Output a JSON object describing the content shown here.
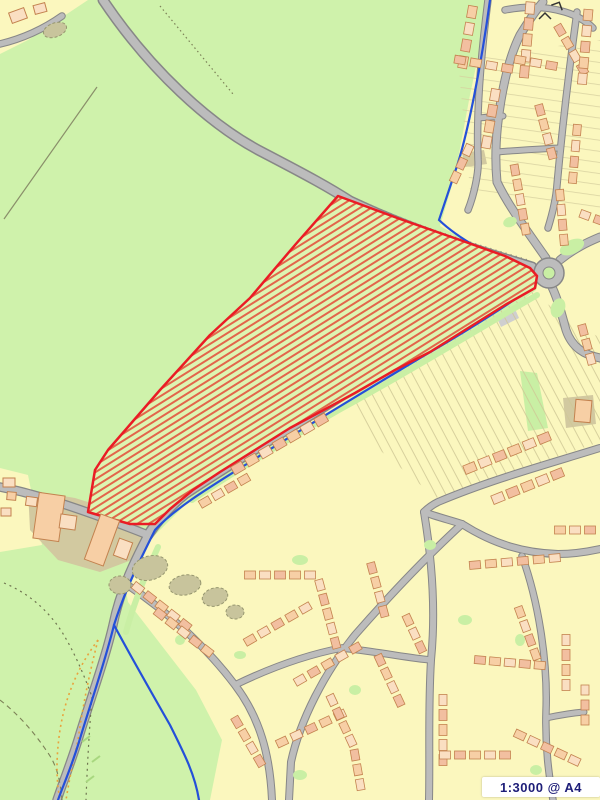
{
  "meta": {
    "scale_label": "1:3000 @ A4"
  },
  "colors": {
    "field_green": "#cff2ab",
    "site_green": "#ddf5b2",
    "residential_yellow": "#fbf7be",
    "building_fill": "#f7cfa5",
    "building_fill_2": "#fadfc2",
    "building_fill_3": "#f2bfa0",
    "building_outline": "#c3824f",
    "khaki": "#d2c9a0",
    "road_fill": "#bcbcbc",
    "road_casing": "#878787",
    "verge_green": "#c9efa4",
    "boundary_blue": "#2450d9",
    "site_red": "#ea1c25",
    "hatch_red": "#e2654a",
    "olive_line": "#7c8157",
    "orange_dots": "#e8a33d",
    "tree_fill": "#c8c49c",
    "tree_outline": "#96966f",
    "plot_line": "#cfc795",
    "scale_text": "#1e1e78"
  },
  "map": {
    "width": 600,
    "height": 800,
    "regions": [
      {
        "name": "residential-main",
        "fill": "#fbf7be",
        "points": "490,0 600,0 600,800 210,800 222,740 196,690 128,602 123,575 150,540 185,505 245,465 305,422 365,390 425,360 470,336 510,310 536,290 540,276 510,258 470,243 440,226 455,175 470,95"
      },
      {
        "name": "residential-topleft",
        "fill": "#fbf7be",
        "points": "0,0 88,0 58,20 28,40 0,54"
      },
      {
        "name": "residential-left-strip",
        "fill": "#fbf7be",
        "points": "0,468 28,475 42,545 0,552"
      },
      {
        "name": "farm-khaki",
        "fill": "#d2c9a0",
        "points": "28,490 75,498 120,512 148,532 142,556 100,572 58,560 30,530"
      },
      {
        "name": "green-wedge-plot",
        "fill": "#c9efa4",
        "points": "520,371 537,373 548,428 528,431"
      },
      {
        "name": "khaki-block-e",
        "fill": "#d2c9a0",
        "points": "563,398 593,395 596,424 566,428"
      },
      {
        "name": "khaki-block-ne",
        "fill": "#d2c9a0",
        "points": "462,153 484,150 487,164 465,167"
      },
      {
        "name": "gray-yard",
        "fill": "#c9c9c9",
        "points": "162,494 176,491 179,501 165,504"
      },
      {
        "name": "gray-strip",
        "fill": "#cfcfcf",
        "points": "497,318 515,309 519,318 501,327"
      }
    ],
    "plot_patterns": [
      {
        "name": "garden-plots-mid",
        "points": "352,398 532,292 558,312 600,338 600,442 436,498 368,440",
        "angle": 62,
        "spacing": 9,
        "color": "#cfc795",
        "width": 0.9
      },
      {
        "name": "garden-plots-ne",
        "points": "458,60 600,40 600,210 470,190",
        "angle": 8,
        "spacing": 11,
        "color": "#d6cf9e",
        "width": 0.8
      }
    ],
    "road_dot_lines": [
      {
        "d": "M99,-7 C146,63 206,118 258,145 C306,170 326,181 346,194 C416,227 476,244 528,260",
        "dash": "1.3 4"
      },
      {
        "d": "M107,7 C154,77 214,132 266,159 C314,184 334,195 354,208 C424,241 484,258 536,274",
        "dash": "1.3 4"
      },
      {
        "d": "M537,295 C475,331 405,374 335,412 C285,441 230,474 190,501",
        "dash": "1.3 4"
      },
      {
        "d": "M527,277 C465,313 395,356 325,394 C275,423 220,456 180,483",
        "dash": "1.3 4"
      }
    ],
    "green_strips": [
      {
        "d": "M537,295 C477,330 407,373 337,411 C287,440 232,473 192,500",
        "width": 6
      },
      {
        "d": "M158,547 C146,574 134,602 126,632",
        "width": 6
      }
    ],
    "roads": [
      {
        "name": "road-main-nw",
        "d": "M103,0 C150,70 210,125 262,152 C310,177 330,188 350,201 C420,234 480,251 532,267",
        "w": 8,
        "cw": 11
      },
      {
        "name": "road-sw",
        "d": "M532,278 C470,314 400,357 330,403 C280,434 225,467 185,494 C170,506 158,520 148,535",
        "w": 8,
        "cw": 11
      },
      {
        "name": "road-farm-w",
        "d": "M148,535 C110,520 70,505 30,494 C20,491 10,489 0,487",
        "w": 7,
        "cw": 9.5
      },
      {
        "name": "road-ssw",
        "d": "M148,535 C135,560 120,590 113,625 C105,660 90,700 78,740 C70,765 62,785 57,800",
        "w": 7,
        "cw": 9.5
      },
      {
        "name": "road-n-branch",
        "d": "M546,258 C525,228 508,205 497,182 C492,130 505,65 520,35 C528,22 536,10 543,2",
        "w": 7,
        "cw": 9
      },
      {
        "name": "road-arm-ne",
        "d": "M560,260 C575,248 588,242 600,237",
        "w": 7,
        "cw": 9
      },
      {
        "name": "road-arm-s",
        "d": "M552,287 C558,300 562,315 566,330 C572,348 585,355 600,358",
        "w": 7,
        "cw": 9
      },
      {
        "name": "road-topleft-spur",
        "d": "M0,44 C25,38 45,28 62,16",
        "w": 5.5,
        "cw": 7.5
      },
      {
        "name": "road-ne-a",
        "d": "M488,0 C481,55 476,110 478,160 C479,172 474,195 468,210",
        "w": 5.5,
        "cw": 7.5
      },
      {
        "name": "road-ne-b",
        "d": "M478,118 L503,116",
        "w": 5,
        "cw": 7
      },
      {
        "name": "road-ne-d",
        "d": "M577,12 C569,70 562,130 557,185 C556,200 552,215 548,228",
        "w": 5.5,
        "cw": 7.5
      },
      {
        "name": "road-ne-e",
        "d": "M497,152 C520,150 540,149 558,148",
        "w": 5,
        "cw": 7
      },
      {
        "name": "road-ne-f",
        "d": "M505,10 C525,6 545,6 565,12 C575,15 585,20 593,28",
        "w": 5.5,
        "cw": 7.5
      },
      {
        "name": "street-a",
        "d": "M462,524 C425,558 390,595 355,635 C325,672 300,720 291,762 L289,800",
        "w": 6,
        "cw": 8
      },
      {
        "name": "street-b",
        "d": "M126,584 C165,610 205,645 235,685 C260,718 270,755 272,800",
        "w": 6,
        "cw": 8
      },
      {
        "name": "street-c",
        "d": "M600,448 C545,465 490,480 438,502 C432,505 428,508 424,512",
        "w": 6,
        "cw": 8
      },
      {
        "name": "street-d",
        "d": "M424,512 C432,560 436,610 431,660 C428,710 430,755 429,800",
        "w": 6,
        "cw": 8
      },
      {
        "name": "street-e",
        "d": "M235,685 C270,668 305,655 342,648",
        "w": 5.5,
        "cw": 7.5
      },
      {
        "name": "street-g",
        "d": "M342,648 C380,652 408,658 431,660",
        "w": 5.5,
        "cw": 7.5
      },
      {
        "name": "street-h",
        "d": "M462,524 C495,545 525,553 558,554 C572,554 586,552 600,549",
        "w": 6,
        "cw": 8
      },
      {
        "name": "street-i",
        "d": "M522,556 C538,600 548,660 546,712 C545,748 549,775 553,800",
        "w": 5.5,
        "cw": 7.5
      },
      {
        "name": "street-k",
        "d": "M546,718 C560,715 572,713 584,712",
        "w": 5,
        "cw": 7
      },
      {
        "name": "street-n",
        "d": "M126,584 C120,600 116,612 113,625",
        "w": 5.5,
        "cw": 7.5
      },
      {
        "name": "street-ak",
        "d": "M424,512 C437,517 450,520 462,524",
        "w": 6,
        "cw": 8
      }
    ],
    "roundabout": {
      "cx": 549,
      "cy": 273,
      "r_outer": 15,
      "r_island": 6
    },
    "lines": [
      {
        "name": "field-boundary-nw",
        "d": "M97,87 L4,219",
        "color": "#8a8f6a",
        "width": 1.2,
        "dash": ""
      },
      {
        "name": "track-top",
        "d": "M160,6 L233,94",
        "color": "#7c8157",
        "width": 1.2,
        "dash": "1.5 3"
      },
      {
        "name": "path-sw-1",
        "d": "M4,583 Q40,598 62,632 Q78,658 92,697",
        "color": "#6f7550",
        "width": 1.2,
        "dash": "2 4"
      },
      {
        "name": "path-sw-2",
        "d": "M92,697 Q88,745 86,800",
        "color": "#6f7550",
        "width": 1.2,
        "dash": "2 4"
      },
      {
        "name": "path-sw-3",
        "d": "M0,700 Q28,722 50,756 Q60,772 62,800",
        "color": "#7c8157",
        "width": 1.1,
        "dash": "5 4"
      },
      {
        "name": "orange-loop-left",
        "d": "M98,640 Q68,680 60,730 Q54,770 60,800",
        "color": "#e8a33d",
        "width": 1.6,
        "dash": "2 3.5"
      },
      {
        "name": "orange-loop-right",
        "d": "M98,640 Q85,690 78,740 Q70,775 66,800",
        "color": "#e8a33d",
        "width": 1.6,
        "dash": "2 3.5"
      },
      {
        "name": "grass-dash-1",
        "d": "M82,742 L90,736",
        "color": "#a8d77f",
        "width": 2,
        "dash": ""
      },
      {
        "name": "grass-dash-2",
        "d": "M92,762 L100,756",
        "color": "#a8d77f",
        "width": 2,
        "dash": ""
      },
      {
        "name": "grass-dash-3",
        "d": "M86,782 L94,776",
        "color": "#a8d77f",
        "width": 2,
        "dash": ""
      }
    ],
    "blue_boundary": [
      {
        "name": "blue-main",
        "d": "M490,0 C482,60 468,135 455,172 L439,220 C460,240 490,255 520,268 C530,272 536,276 533,287 C500,310 460,335 420,358 C370,388 300,430 250,462 C210,487 175,508 155,530 C140,560 125,590 114,625 C105,662 90,705 79,742 C71,768 63,786 58,800"
      },
      {
        "name": "blue-branch",
        "d": "M114,625 C130,655 150,690 170,725 C185,755 195,775 199,800"
      }
    ],
    "site_polygon": {
      "points": "338,196 400,219 460,240 505,256 530,268 537,276 535,288 505,305 465,330 430,352 395,370 355,393 320,412 290,428 255,450 220,472 193,490 170,509 155,524 130,524 105,517 88,512 95,470 108,450 160,390 210,335 250,298 295,245",
      "hatch_angle": -32,
      "hatch_spacing": 6,
      "hatch_width": 2
    },
    "buildings": [
      {
        "x": 36,
        "y": 494,
        "w": 26,
        "h": 46,
        "rot": 8,
        "f": 0
      },
      {
        "x": 60,
        "y": 515,
        "w": 16,
        "h": 14,
        "rot": 8,
        "f": 1
      },
      {
        "x": 92,
        "y": 516,
        "w": 20,
        "h": 48,
        "rot": 20,
        "f": 0
      },
      {
        "x": 116,
        "y": 540,
        "w": 14,
        "h": 18,
        "rot": 20,
        "f": 1
      },
      {
        "x": 26,
        "y": 497,
        "w": 11,
        "h": 9,
        "rot": 8,
        "f": 1
      },
      {
        "x": 3,
        "y": 478,
        "w": 12,
        "h": 9,
        "rot": 0,
        "f": 1
      },
      {
        "x": 7,
        "y": 492,
        "w": 9,
        "h": 8,
        "rot": 5,
        "f": 0
      },
      {
        "x": 1,
        "y": 508,
        "w": 10,
        "h": 8,
        "rot": 0,
        "f": 1
      },
      {
        "x": 10,
        "y": 10,
        "w": 16,
        "h": 11,
        "rot": -20,
        "f": 1
      },
      {
        "x": 34,
        "y": 4,
        "w": 12,
        "h": 9,
        "rot": -15,
        "f": 1
      },
      {
        "x": 575,
        "y": 400,
        "w": 16,
        "h": 22,
        "rot": 5,
        "f": 0
      }
    ],
    "house_rows": [
      {
        "x": 472,
        "y": 12,
        "rot": 100,
        "n": 4,
        "sp": 17,
        "w": 12,
        "h": 9
      },
      {
        "x": 530,
        "y": 8,
        "rot": 95,
        "n": 5,
        "sp": 16,
        "w": 12,
        "h": 9
      },
      {
        "x": 560,
        "y": 30,
        "rot": 60,
        "n": 4,
        "sp": 15,
        "w": 11,
        "h": 8
      },
      {
        "x": 588,
        "y": 15,
        "rot": 95,
        "n": 5,
        "sp": 16,
        "w": 11,
        "h": 9
      },
      {
        "x": 495,
        "y": 95,
        "rot": 100,
        "n": 4,
        "sp": 16,
        "w": 12,
        "h": 9
      },
      {
        "x": 540,
        "y": 110,
        "rot": 75,
        "n": 4,
        "sp": 15,
        "w": 11,
        "h": 8
      },
      {
        "x": 577,
        "y": 130,
        "rot": 95,
        "n": 4,
        "sp": 16,
        "w": 11,
        "h": 8
      },
      {
        "x": 468,
        "y": 150,
        "rot": 115,
        "n": 3,
        "sp": 15,
        "w": 11,
        "h": 8
      },
      {
        "x": 515,
        "y": 170,
        "rot": 80,
        "n": 5,
        "sp": 15,
        "w": 11,
        "h": 8
      },
      {
        "x": 560,
        "y": 195,
        "rot": 85,
        "n": 4,
        "sp": 15,
        "w": 11,
        "h": 8
      },
      {
        "x": 585,
        "y": 215,
        "rot": 20,
        "n": 3,
        "sp": 15,
        "w": 10,
        "h": 8
      },
      {
        "x": 583,
        "y": 330,
        "rot": 75,
        "n": 3,
        "sp": 15,
        "w": 11,
        "h": 8
      },
      {
        "x": 470,
        "y": 468,
        "rot": -22,
        "n": 6,
        "sp": 16,
        "w": 12,
        "h": 9
      },
      {
        "x": 498,
        "y": 498,
        "rot": -22,
        "n": 5,
        "sp": 16,
        "w": 12,
        "h": 9
      },
      {
        "x": 238,
        "y": 468,
        "rot": -30,
        "n": 7,
        "sp": 16,
        "w": 12,
        "h": 9
      },
      {
        "x": 205,
        "y": 502,
        "rot": -30,
        "n": 4,
        "sp": 15,
        "w": 11,
        "h": 8
      },
      {
        "x": 138,
        "y": 588,
        "rot": 38,
        "n": 5,
        "sp": 15,
        "w": 11,
        "h": 8
      },
      {
        "x": 160,
        "y": 614,
        "rot": 38,
        "n": 5,
        "sp": 15,
        "w": 11,
        "h": 8
      },
      {
        "x": 250,
        "y": 575,
        "rot": 0,
        "n": 5,
        "sp": 15,
        "w": 11,
        "h": 8
      },
      {
        "x": 320,
        "y": 585,
        "rot": 75,
        "n": 5,
        "sp": 15,
        "w": 11,
        "h": 8
      },
      {
        "x": 372,
        "y": 568,
        "rot": 75,
        "n": 4,
        "sp": 15,
        "w": 11,
        "h": 8
      },
      {
        "x": 250,
        "y": 640,
        "rot": -30,
        "n": 5,
        "sp": 16,
        "w": 11,
        "h": 8
      },
      {
        "x": 300,
        "y": 680,
        "rot": -30,
        "n": 5,
        "sp": 16,
        "w": 11,
        "h": 8
      },
      {
        "x": 237,
        "y": 722,
        "rot": 60,
        "n": 4,
        "sp": 15,
        "w": 11,
        "h": 8
      },
      {
        "x": 282,
        "y": 742,
        "rot": -25,
        "n": 5,
        "sp": 16,
        "w": 11,
        "h": 8
      },
      {
        "x": 332,
        "y": 700,
        "rot": 65,
        "n": 4,
        "sp": 15,
        "w": 11,
        "h": 8
      },
      {
        "x": 380,
        "y": 660,
        "rot": 65,
        "n": 4,
        "sp": 15,
        "w": 11,
        "h": 8
      },
      {
        "x": 408,
        "y": 620,
        "rot": 65,
        "n": 3,
        "sp": 15,
        "w": 11,
        "h": 8
      },
      {
        "x": 443,
        "y": 700,
        "rot": 90,
        "n": 5,
        "sp": 15,
        "w": 11,
        "h": 8
      },
      {
        "x": 475,
        "y": 565,
        "rot": -5,
        "n": 6,
        "sp": 16,
        "w": 11,
        "h": 8
      },
      {
        "x": 520,
        "y": 612,
        "rot": 70,
        "n": 4,
        "sp": 15,
        "w": 11,
        "h": 8
      },
      {
        "x": 566,
        "y": 640,
        "rot": 90,
        "n": 4,
        "sp": 15,
        "w": 11,
        "h": 8
      },
      {
        "x": 480,
        "y": 660,
        "rot": 5,
        "n": 5,
        "sp": 15,
        "w": 11,
        "h": 8
      },
      {
        "x": 520,
        "y": 735,
        "rot": 25,
        "n": 5,
        "sp": 15,
        "w": 11,
        "h": 8
      },
      {
        "x": 445,
        "y": 755,
        "rot": 0,
        "n": 5,
        "sp": 15,
        "w": 11,
        "h": 8
      },
      {
        "x": 355,
        "y": 755,
        "rot": 80,
        "n": 3,
        "sp": 15,
        "w": 11,
        "h": 8
      },
      {
        "x": 560,
        "y": 530,
        "rot": 0,
        "n": 3,
        "sp": 15,
        "w": 11,
        "h": 8
      },
      {
        "x": 585,
        "y": 690,
        "rot": 90,
        "n": 3,
        "sp": 15,
        "w": 10,
        "h": 8
      },
      {
        "x": 460,
        "y": 60,
        "rot": 10,
        "n": 4,
        "sp": 16,
        "w": 11,
        "h": 8
      },
      {
        "x": 520,
        "y": 60,
        "rot": 10,
        "n": 3,
        "sp": 16,
        "w": 11,
        "h": 8
      }
    ],
    "green_patches": [
      {
        "x": 572,
        "y": 247,
        "rx": 13,
        "ry": 7,
        "rot": -25
      },
      {
        "x": 558,
        "y": 308,
        "rx": 7,
        "ry": 10,
        "rot": 20
      },
      {
        "x": 300,
        "y": 560,
        "rx": 8,
        "ry": 5,
        "rot": 0
      },
      {
        "x": 430,
        "y": 545,
        "rx": 6,
        "ry": 5,
        "rot": 0
      },
      {
        "x": 240,
        "y": 655,
        "rx": 6,
        "ry": 4,
        "rot": 0
      },
      {
        "x": 465,
        "y": 620,
        "rx": 7,
        "ry": 5,
        "rot": 0
      },
      {
        "x": 520,
        "y": 640,
        "rx": 5,
        "ry": 6,
        "rot": 0
      },
      {
        "x": 355,
        "y": 690,
        "rx": 6,
        "ry": 5,
        "rot": 0
      },
      {
        "x": 300,
        "y": 775,
        "rx": 7,
        "ry": 5,
        "rot": 0
      },
      {
        "x": 536,
        "y": 770,
        "rx": 6,
        "ry": 5,
        "rot": 0
      },
      {
        "x": 180,
        "y": 640,
        "rx": 5,
        "ry": 5,
        "rot": 0
      },
      {
        "x": 510,
        "y": 222,
        "rx": 7,
        "ry": 5,
        "rot": -20
      }
    ],
    "tree_blobs": [
      {
        "cx": 150,
        "cy": 568,
        "rx": 18,
        "ry": 12,
        "rot": -15
      },
      {
        "cx": 185,
        "cy": 585,
        "rx": 16,
        "ry": 10,
        "rot": -10
      },
      {
        "cx": 215,
        "cy": 597,
        "rx": 13,
        "ry": 9,
        "rot": -15
      },
      {
        "cx": 120,
        "cy": 585,
        "rx": 11,
        "ry": 9,
        "rot": 0
      },
      {
        "cx": 235,
        "cy": 612,
        "rx": 9,
        "ry": 7,
        "rot": 0
      },
      {
        "cx": 55,
        "cy": 30,
        "rx": 12,
        "ry": 7,
        "rot": -20
      }
    ],
    "symbols": [
      {
        "type": "chevron",
        "x": 545,
        "y": 16,
        "rot": 0
      },
      {
        "type": "chevron",
        "x": 558,
        "y": 5,
        "rot": 25
      }
    ]
  }
}
